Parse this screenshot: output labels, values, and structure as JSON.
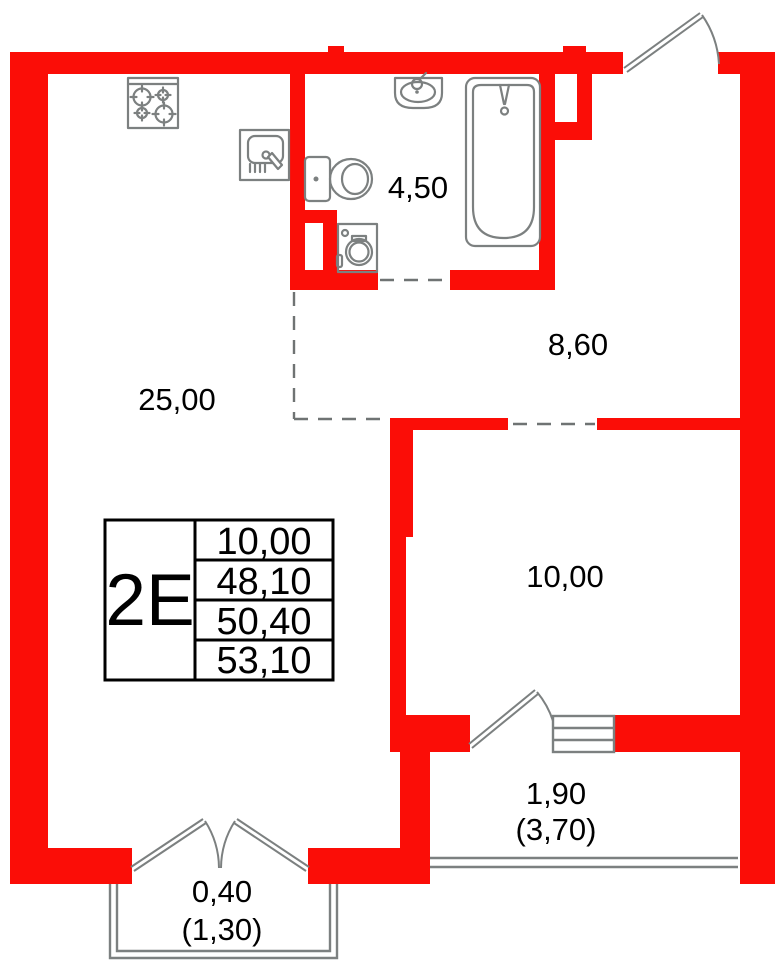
{
  "document": {
    "type": "apartment-floor-plan"
  },
  "colors": {
    "wall": "#fb0d07",
    "fixture": "#7c8080",
    "dash": "#6f7373",
    "text": "#000000",
    "table_border": "#000000",
    "background": "#ffffff"
  },
  "rooms": [
    {
      "name": "kitchen-living-room",
      "area": "25,00"
    },
    {
      "name": "bathroom",
      "area": "4,50"
    },
    {
      "name": "hallway",
      "area": "8,60"
    },
    {
      "name": "bedroom",
      "area": "10,00"
    },
    {
      "name": "loggia",
      "area": "1,90",
      "area_with_coefficient": "(3,70)"
    },
    {
      "name": "balcony",
      "area": "0,40",
      "area_with_coefficient": "(1,30)"
    }
  ],
  "info_table": {
    "type_label": "2E",
    "values": [
      "10,00",
      "48,10",
      "50,40",
      "53,10"
    ]
  },
  "icons": [
    "stove-icon",
    "kitchen-sink-icon",
    "washbasin-icon",
    "toilet-icon",
    "washing-machine-icon",
    "bathtub-icon",
    "entry-door",
    "bedroom-door",
    "balcony-french-doors",
    "bedroom-window",
    "loggia-railing",
    "balcony-railing"
  ]
}
